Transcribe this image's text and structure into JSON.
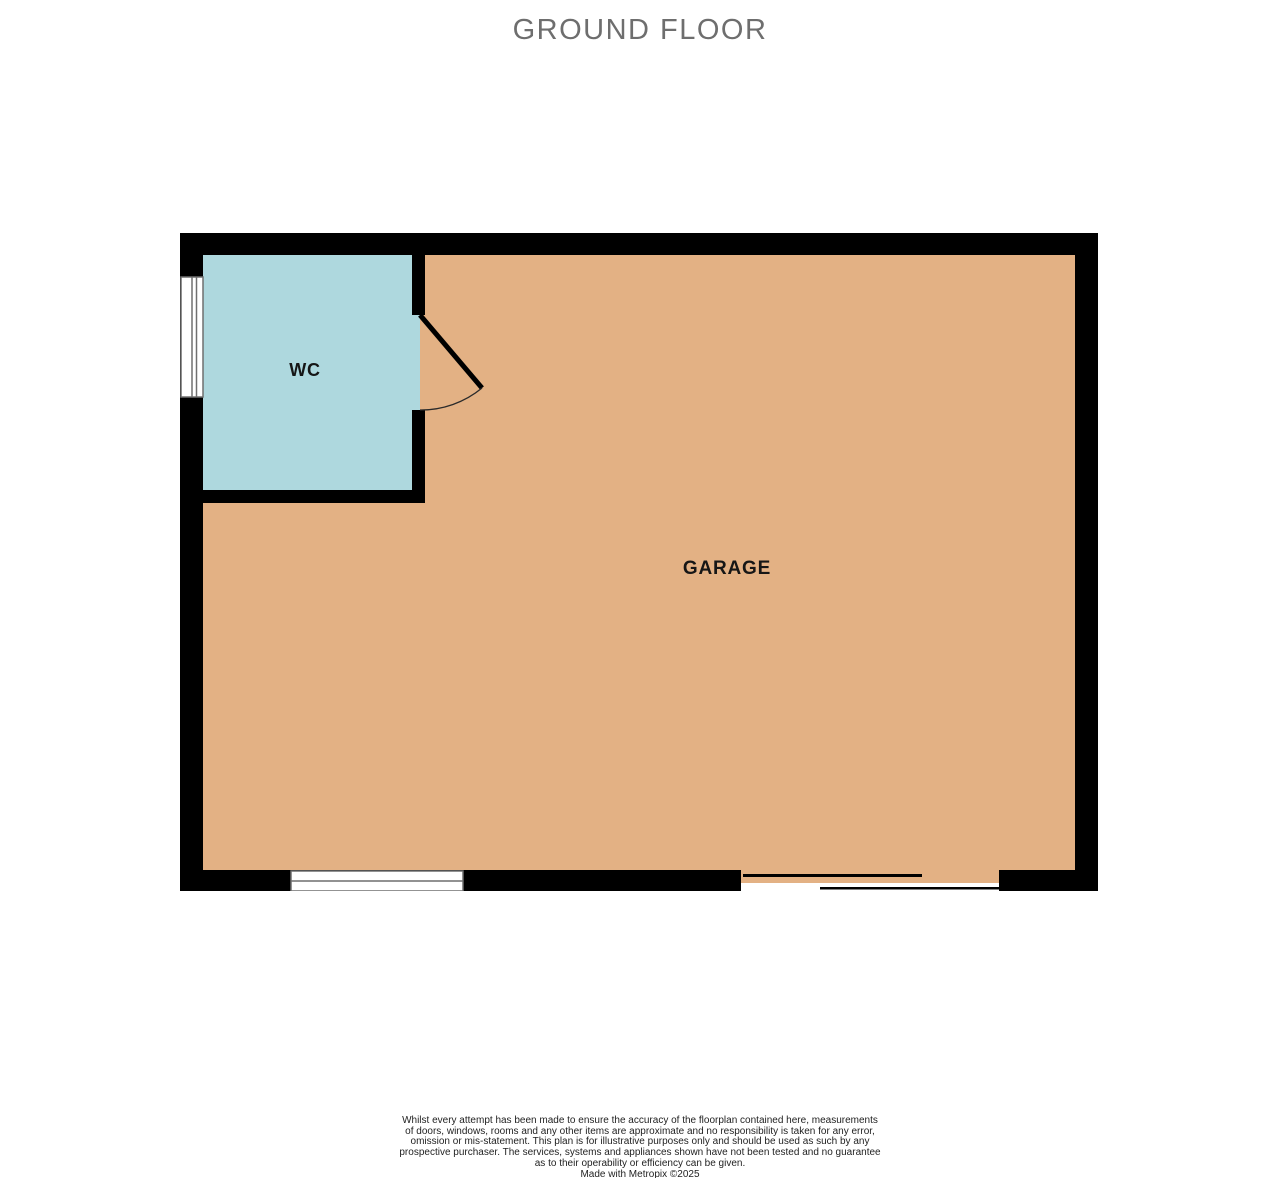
{
  "title": "GROUND FLOOR",
  "floor_plan": {
    "rooms": [
      {
        "id": "wc",
        "label": "WC",
        "fill": "#aed8de"
      },
      {
        "id": "garage",
        "label": "GARAGE",
        "fill": "#e3b184"
      }
    ]
  },
  "colors": {
    "wall": "#000000",
    "wc_fill": "#aed8de",
    "garage_fill": "#e3b184",
    "title_text": "#6e6e6e",
    "window_frame": "#6f6f6f",
    "door_line": "#000000",
    "background": "#ffffff"
  },
  "footer": {
    "lines": [
      "Whilst every attempt has been made to ensure the accuracy of the floorplan contained here, measurements",
      "of doors, windows, rooms and any other items are approximate and no responsibility is taken for any error,",
      "omission or mis-statement. This plan is for illustrative purposes only and should be used as such by any",
      "prospective purchaser. The services, systems and appliances shown have not been tested and no guarantee",
      "as to their operability or efficiency can be given.",
      "Made with Metropix ©2025"
    ]
  }
}
